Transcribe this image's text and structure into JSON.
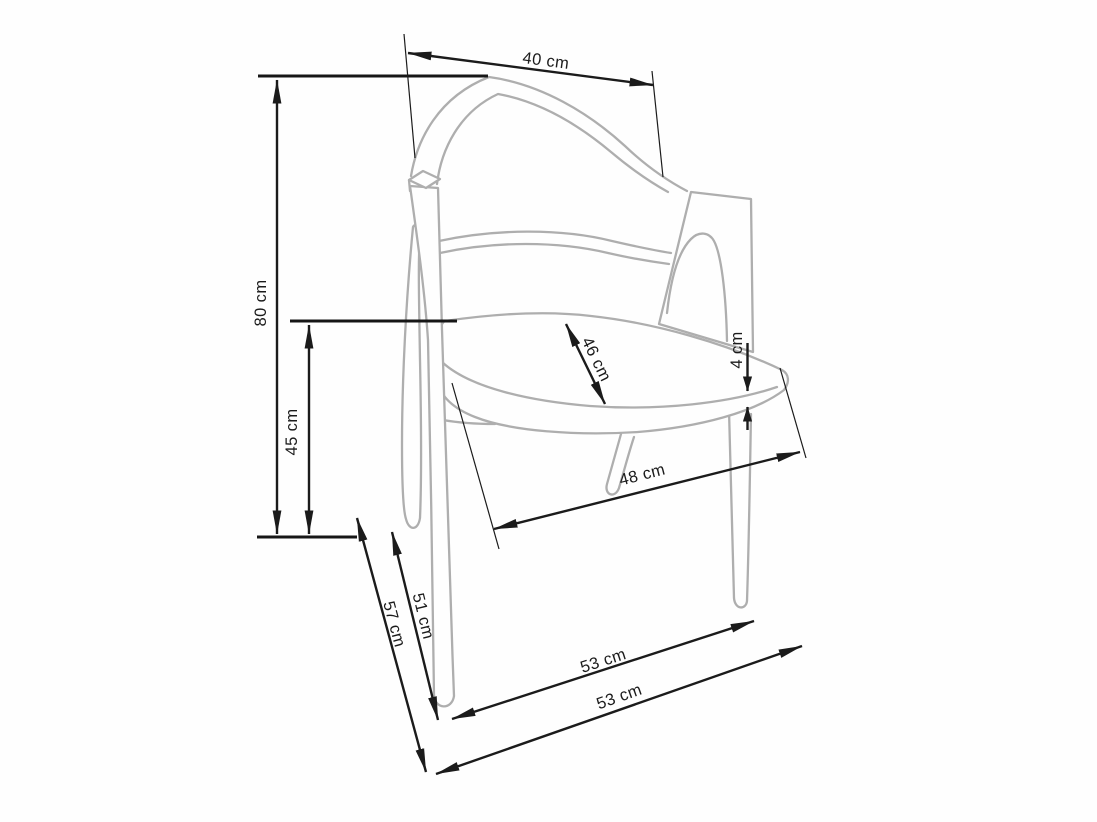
{
  "figure": {
    "title": "Chair technical drawing with dimensions",
    "unit": "cm",
    "style": {
      "background": "#fefefe",
      "drawing_color": "#aeaeae",
      "dimension_color": "#1b1b1b"
    },
    "dimensions": {
      "back_width": {
        "label": "40 cm",
        "value": 40,
        "measures": "backrest top width"
      },
      "total_height": {
        "label": "80 cm",
        "value": 80,
        "measures": "overall height"
      },
      "seat_height": {
        "label": "45 cm",
        "value": 45,
        "measures": "seat height"
      },
      "seat_depth": {
        "label": "46 cm",
        "value": 46,
        "measures": "seat depth"
      },
      "seat_thickness": {
        "label": "4 cm",
        "value": 4,
        "measures": "seat edge thickness"
      },
      "seat_width": {
        "label": "48 cm",
        "value": 48,
        "measures": "seat front width"
      },
      "leg_span_inner": {
        "label": "51 cm",
        "value": 51,
        "measures": "front leg span inner"
      },
      "leg_span_outer": {
        "label": "57 cm",
        "value": 57,
        "measures": "front leg span outer"
      },
      "base_span_inner": {
        "label": "53 cm",
        "value": 53,
        "measures": "floor span between legs"
      },
      "base_span_outer": {
        "label": "53 cm",
        "value": 53,
        "measures": "floor span outer"
      }
    }
  }
}
